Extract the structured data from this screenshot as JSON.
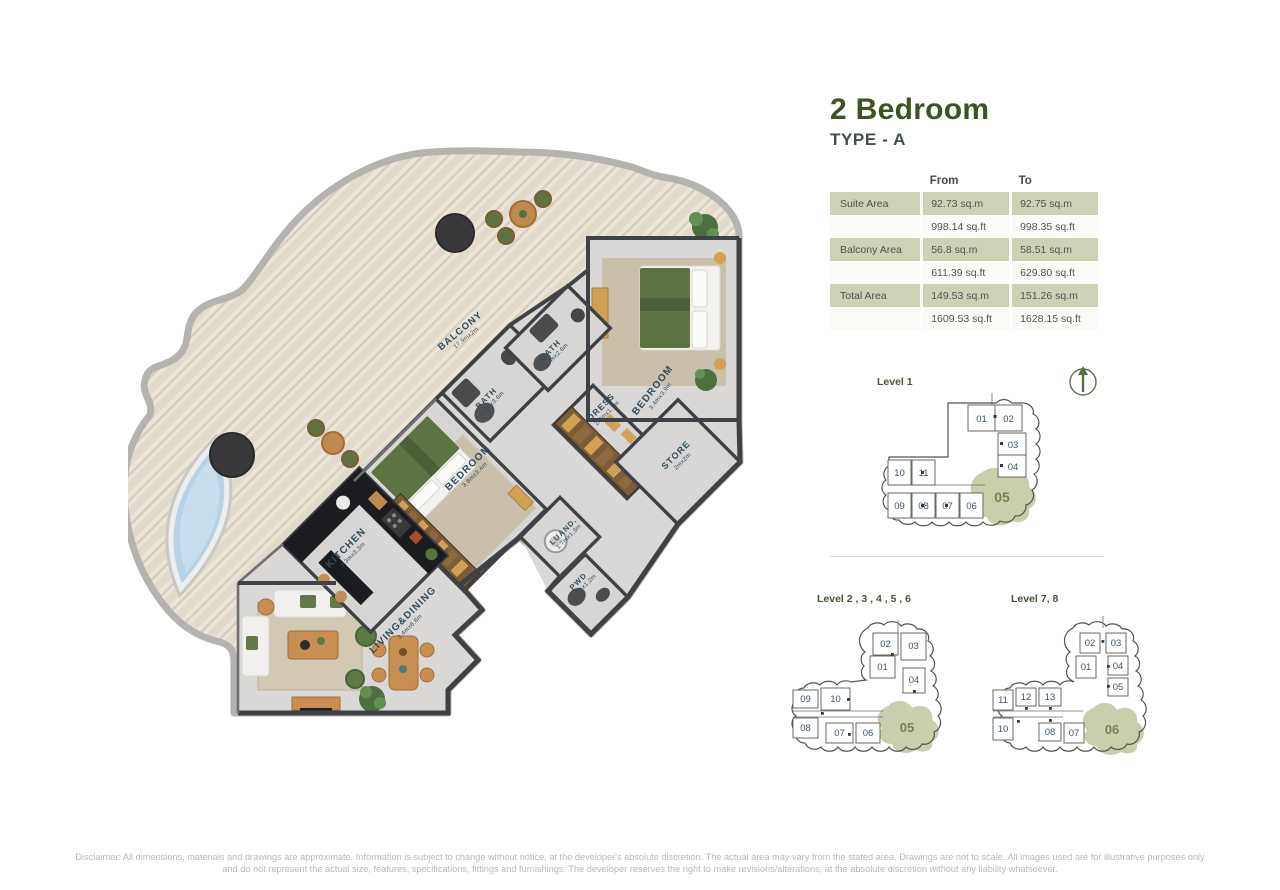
{
  "header": {
    "title": "2 Bedroom",
    "subtitle": "TYPE - A"
  },
  "area_table": {
    "col_from": "From",
    "col_to": "To",
    "rows": [
      {
        "label": "Suite Area",
        "from": "92.73 sq.m",
        "to": "92.75 sq.m"
      },
      {
        "label": "",
        "from": "998.14 sq.ft",
        "to": "998.35 sq.ft"
      },
      {
        "label": "Balcony Area",
        "from": "56.8 sq.m",
        "to": "58.51 sq.m"
      },
      {
        "label": "",
        "from": "611.39 sq.ft",
        "to": "629.80 sq.ft"
      },
      {
        "label": "Total Area",
        "from": "149.53 sq.m",
        "to": "151.26 sq.m"
      },
      {
        "label": "",
        "from": "1609.53 sq.ft",
        "to": "1628.15 sq.ft"
      }
    ]
  },
  "floorplan": {
    "rooms": {
      "balcony": {
        "name": "BALCONY",
        "dims": "17.9mx2m"
      },
      "bath_a": {
        "name": "BATH",
        "dims": "1.7mx3.6m"
      },
      "bath_b": {
        "name": "BATH",
        "dims": "1.7mx2.6m"
      },
      "dress": {
        "name": "DRESS",
        "dims": "2.3mx1.7m"
      },
      "bedroom_a": {
        "name": "BEDROOM",
        "dims": "3.4mx3.9m"
      },
      "store": {
        "name": "STORE",
        "dims": "2mx2m"
      },
      "bedroom_b": {
        "name": "BEDROOM",
        "dims": "3.8mx3.4m"
      },
      "laundry": {
        "name": "LUAND.",
        "dims": "1.7mx1.3m"
      },
      "powder": {
        "name": "PWD",
        "dims": "1.7mx1.2m"
      },
      "kitchen": {
        "name": "KITCHEN",
        "dims": "3.3mx3.3m"
      },
      "living": {
        "name": "LIVING&DINING",
        "dims": "3.4mx6.8m"
      }
    }
  },
  "keyplans": {
    "level1": {
      "label": "Level 1",
      "highlight": "05",
      "units": {
        "u01": "01",
        "u02": "02",
        "u03": "03",
        "u04": "04",
        "u06": "06",
        "u07": "07",
        "u08": "08",
        "u09": "09",
        "u10": "10",
        "u11": "11"
      }
    },
    "level23456": {
      "label": "Level 2 , 3 , 4 , 5 , 6",
      "highlight": "05",
      "units": {
        "u01": "01",
        "u02": "02",
        "u03": "03",
        "u04": "04",
        "u06": "06",
        "u07": "07",
        "u08": "08",
        "u09": "09",
        "u10": "10"
      }
    },
    "level78": {
      "label": "Level 7, 8",
      "highlight": "06",
      "units": {
        "u01": "01",
        "u02": "02",
        "u03": "03",
        "u04": "04",
        "u05": "05",
        "u07": "07",
        "u08": "08",
        "u10": "10",
        "u11": "11",
        "u12": "12",
        "u13": "13"
      }
    }
  },
  "disclaimer": {
    "line1": "Disclaimer: All dimensions, materials and drawings are approximate. Information is subject to change without notice, at the developer's absolute discretion. The actual area may vary from the stated area. Drawings are not to scale. All images used are for illustrative purposes only",
    "line2": "and do not represent the actual size, features, specifications, fittings and furnishings. The developer reserves the right to make revisions/alterations, at the absolute discretion without any liability whatsoever."
  },
  "colors": {
    "accent_green": "#3e5322",
    "table_shade": "#cdd1b6",
    "keyplan_highlight": "#c9cead",
    "highlight_number": "#78824e",
    "room_label": "#2f4d60"
  }
}
